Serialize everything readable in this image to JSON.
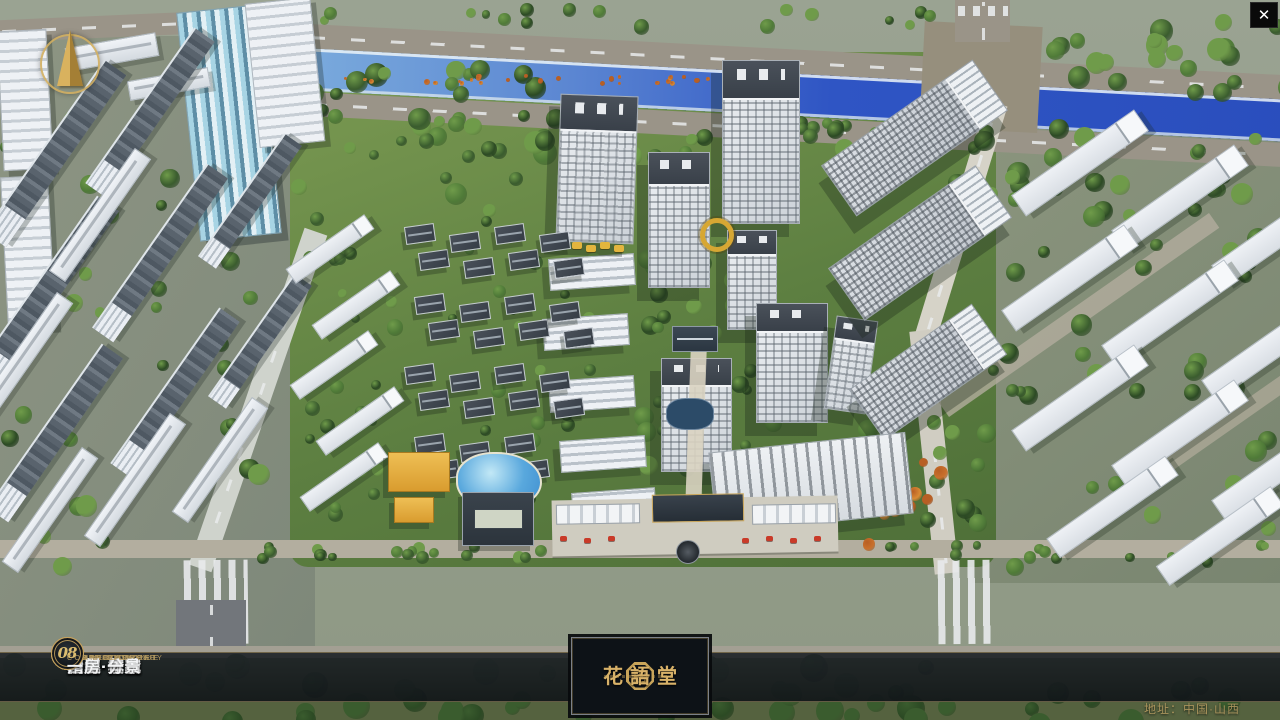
{
  "close_button": {
    "icon": "✕"
  },
  "menu": {
    "items": [
      {
        "num": "01",
        "label": "品牌·介绍",
        "sub": "BRAND SUPPORT"
      },
      {
        "num": "02",
        "label": "区位·价值",
        "sub": "LOCATION VALUE"
      },
      {
        "num": "03",
        "label": "项目·概况",
        "sub": "PROJECT SURVEY"
      },
      {
        "num": "04",
        "label": "建筑·鉴赏",
        "sub": "APPRECIATION"
      },
      {
        "num": "05",
        "label": "园林·景观",
        "sub": "GARDEN STREET"
      },
      {
        "num": "06",
        "label": "精装·体验",
        "sub": "EXPERIENCE"
      },
      {
        "num": "07",
        "label": "户型·分布",
        "sub": "SHOW ROOM"
      },
      {
        "num": "08",
        "label": "一房·一景",
        "sub": "COMMUNITY"
      }
    ]
  },
  "logo": {
    "name": "花語堂"
  },
  "footer": {
    "address": "地址：中国·山西"
  },
  "colors": {
    "gold": "#c9a55a",
    "bar_bg": "rgba(20,24,29,0.9)",
    "river": "#2f55c4"
  }
}
